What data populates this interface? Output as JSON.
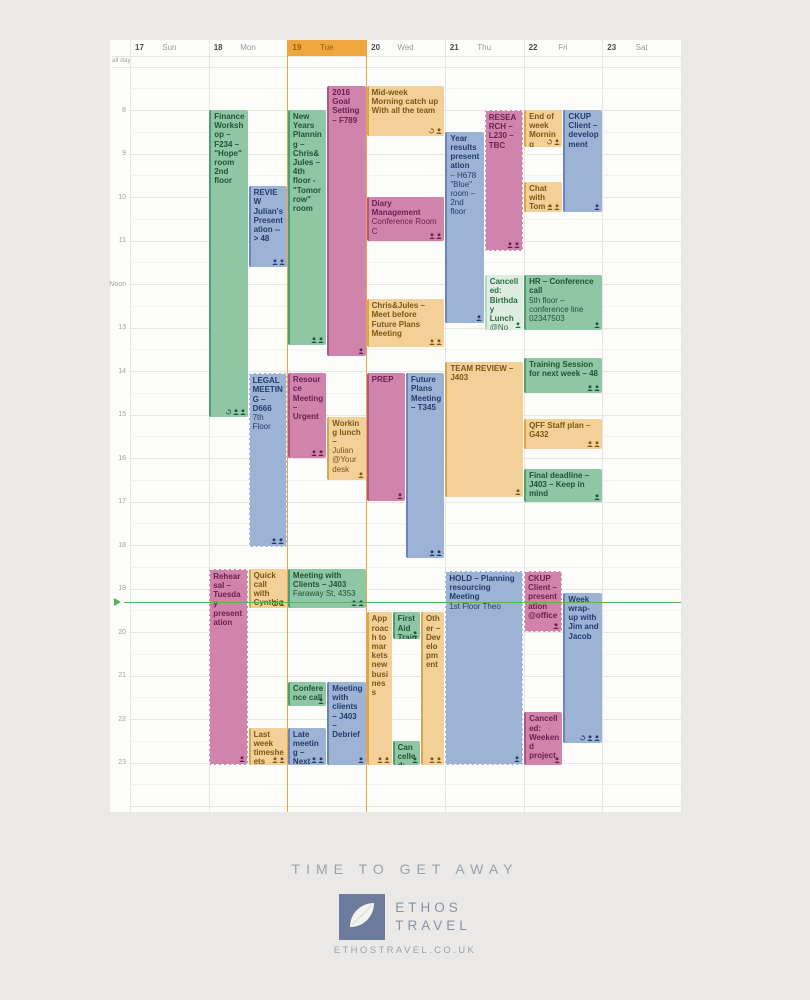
{
  "page": {
    "background": "#eae9e7"
  },
  "calendar": {
    "all_day_label": "all day",
    "days": [
      {
        "num": "17",
        "name": "Sun",
        "today": false
      },
      {
        "num": "18",
        "name": "Mon",
        "today": false
      },
      {
        "num": "19",
        "name": "Tue",
        "today": true
      },
      {
        "num": "20",
        "name": "Wed",
        "today": false
      },
      {
        "num": "21",
        "name": "Thu",
        "today": false
      },
      {
        "num": "22",
        "name": "Fri",
        "today": false
      },
      {
        "num": "23",
        "name": "Sat",
        "today": false
      }
    ],
    "hours": [
      {
        "h": 8,
        "label": "8"
      },
      {
        "h": 9,
        "label": "9"
      },
      {
        "h": 10,
        "label": "10"
      },
      {
        "h": 11,
        "label": "11"
      },
      {
        "h": 12,
        "label": "Noon"
      },
      {
        "h": 13,
        "label": "13"
      },
      {
        "h": 14,
        "label": "14"
      },
      {
        "h": 15,
        "label": "15"
      },
      {
        "h": 16,
        "label": "16"
      },
      {
        "h": 17,
        "label": "17"
      },
      {
        "h": 18,
        "label": "18"
      },
      {
        "h": 19,
        "label": "19"
      },
      {
        "h": 20,
        "label": "20"
      },
      {
        "h": 21,
        "label": "21"
      },
      {
        "h": 22,
        "label": "22"
      },
      {
        "h": 23,
        "label": "23"
      }
    ],
    "now_hour": 19.3,
    "today_color": "#efa63c",
    "now_color": "#57b358"
  },
  "colors": {
    "green": {
      "bg": "#8fc6a4",
      "border": "#4f9e71",
      "text": "#1d5737"
    },
    "greenLight": {
      "bg": "#ddeee0",
      "border": "#b5d8bf",
      "text": "#2e6e45"
    },
    "blue": {
      "bg": "#9db3d6",
      "border": "#6a84b5",
      "text": "#223d6b"
    },
    "pink": {
      "bg": "#d083ab",
      "border": "#b05585",
      "text": "#6b2150"
    },
    "orange": {
      "bg": "#f3d098",
      "border": "#d8a74d",
      "text": "#7b5812"
    }
  },
  "events": [
    {
      "day": 1,
      "lane": [
        0,
        0.5
      ],
      "start": 8.0,
      "end": 15.05,
      "color": "green",
      "dashed": false,
      "title": "Finance Workshop – F234 – \"Hope\" room 2nd floor",
      "detail": "",
      "icons": [
        "repeat",
        "person",
        "person"
      ]
    },
    {
      "day": 1,
      "lane": [
        0.5,
        0.5
      ],
      "start": 9.75,
      "end": 11.6,
      "color": "blue",
      "dashed": false,
      "title": "REVIEW Julian's Presentation --> 48",
      "detail": "",
      "icons": [
        "person",
        "person"
      ]
    },
    {
      "day": 1,
      "lane": [
        0.5,
        0.5
      ],
      "start": 14.05,
      "end": 18.05,
      "color": "blue",
      "dashed": true,
      "title": "LEGAL MEETING – D666",
      "detail": "7th Floor",
      "icons": [
        "person",
        "person"
      ]
    },
    {
      "day": 1,
      "lane": [
        0,
        0.5
      ],
      "start": 18.55,
      "end": 23.05,
      "color": "pink",
      "dashed": true,
      "title": "Rehearsal – Tuesday presentation",
      "detail": "",
      "icons": [
        "person"
      ]
    },
    {
      "day": 1,
      "lane": [
        0.5,
        0.5
      ],
      "start": 18.55,
      "end": 19.45,
      "color": "orange",
      "dashed": false,
      "title": "Quick call with Cynthia – J457",
      "detail": "",
      "icons": [
        "person",
        "person"
      ]
    },
    {
      "day": 1,
      "lane": [
        0.5,
        0.5
      ],
      "start": 22.2,
      "end": 23.05,
      "color": "orange",
      "dashed": false,
      "title": "Last week timesheets supervision – K182",
      "detail": "",
      "icons": [
        "person",
        "person"
      ]
    },
    {
      "day": 2,
      "lane": [
        0,
        0.5
      ],
      "start": 8.0,
      "end": 13.4,
      "color": "green",
      "dashed": false,
      "title": "New Years Planning – Chris&Jules – 4th floor - \"Tomorrow\" room",
      "detail": "",
      "icons": [
        "person",
        "person"
      ]
    },
    {
      "day": 2,
      "lane": [
        0.5,
        0.5
      ],
      "start": 7.45,
      "end": 13.65,
      "color": "pink",
      "dashed": false,
      "title": "2016 Goal Setting – F789",
      "detail": "",
      "icons": [
        "person"
      ]
    },
    {
      "day": 2,
      "lane": [
        0,
        0.5
      ],
      "start": 14.05,
      "end": 16.0,
      "color": "pink",
      "dashed": false,
      "title": "Resource Meeting – Urgent",
      "detail": "",
      "icons": [
        "person",
        "person"
      ]
    },
    {
      "day": 2,
      "lane": [
        0.5,
        0.5
      ],
      "start": 15.05,
      "end": 16.5,
      "color": "orange",
      "dashed": false,
      "title": "Working lunch –",
      "detail": "Julian @Your desk",
      "icons": [
        "person"
      ]
    },
    {
      "day": 2,
      "lane": [
        0,
        1
      ],
      "start": 18.55,
      "end": 19.45,
      "color": "green",
      "dashed": false,
      "title": "Meeting with Clients – J403",
      "detail": "Faraway St, 4353",
      "icons": [
        "person",
        "person"
      ]
    },
    {
      "day": 2,
      "lane": [
        0,
        0.5
      ],
      "start": 21.15,
      "end": 21.7,
      "color": "green",
      "dashed": false,
      "title": "Conference call – contact 02354",
      "detail": "",
      "icons": [
        "person"
      ]
    },
    {
      "day": 2,
      "lane": [
        0.5,
        0.5
      ],
      "start": 21.15,
      "end": 23.05,
      "color": "blue",
      "dashed": false,
      "title": "Meeting with clients – J403 – Debrief",
      "detail": "",
      "icons": [
        "person"
      ]
    },
    {
      "day": 2,
      "lane": [
        0,
        0.5
      ],
      "start": 22.2,
      "end": 23.05,
      "color": "blue",
      "dashed": false,
      "title": "Late meeting – Next steps",
      "detail": "",
      "icons": [
        "person",
        "person"
      ]
    },
    {
      "day": 3,
      "lane": [
        0,
        1
      ],
      "start": 7.45,
      "end": 8.6,
      "color": "orange",
      "dashed": false,
      "title": "Mid-week Morning catch up With all the team",
      "detail": "",
      "icons": [
        "repeat",
        "person"
      ]
    },
    {
      "day": 3,
      "lane": [
        0,
        1
      ],
      "start": 10.0,
      "end": 11.0,
      "color": "pink",
      "dashed": false,
      "title": "Diary Management",
      "detail": "Conference Room C",
      "icons": [
        "person",
        "person"
      ]
    },
    {
      "day": 3,
      "lane": [
        0,
        1
      ],
      "start": 12.35,
      "end": 13.45,
      "color": "orange",
      "dashed": false,
      "title": "Chris&Jules – Meet before Future Plans Meeting",
      "detail": "",
      "icons": [
        "person",
        "person"
      ]
    },
    {
      "day": 3,
      "lane": [
        0,
        0.5
      ],
      "start": 14.05,
      "end": 17.0,
      "color": "pink",
      "dashed": false,
      "title": "PREP",
      "detail": "",
      "icons": [
        "person"
      ]
    },
    {
      "day": 3,
      "lane": [
        0.5,
        0.5
      ],
      "start": 14.05,
      "end": 18.3,
      "color": "blue",
      "dashed": false,
      "title": "Future Plans Meeting – T345",
      "detail": "",
      "icons": [
        "person",
        "person"
      ]
    },
    {
      "day": 3,
      "lane": [
        0,
        0.33
      ],
      "start": 19.55,
      "end": 23.05,
      "color": "orange",
      "dashed": false,
      "title": "Approach to markets new business",
      "detail": "",
      "icons": [
        "person",
        "person"
      ]
    },
    {
      "day": 3,
      "lane": [
        0.33,
        0.36
      ],
      "start": 19.55,
      "end": 20.15,
      "color": "green",
      "dashed": false,
      "title": "First Aid Training",
      "detail": "",
      "icons": [
        "person"
      ]
    },
    {
      "day": 3,
      "lane": [
        0.33,
        0.36
      ],
      "start": 22.5,
      "end": 23.05,
      "color": "green",
      "dashed": false,
      "title": "Cancelled: Drinks",
      "detail": "",
      "icons": [
        "person"
      ]
    },
    {
      "day": 3,
      "lane": [
        0.69,
        0.31
      ],
      "start": 19.55,
      "end": 23.05,
      "color": "orange",
      "dashed": false,
      "title": "Other – Development",
      "detail": "",
      "icons": [
        "person",
        "person"
      ]
    },
    {
      "day": 4,
      "lane": [
        0,
        0.5
      ],
      "start": 8.5,
      "end": 12.9,
      "color": "blue",
      "dashed": false,
      "title": "Year results presentation",
      "detail": "– H678 \"Blue\" room – 2nd floor",
      "icons": [
        "person"
      ]
    },
    {
      "day": 4,
      "lane": [
        0.5,
        0.5
      ],
      "start": 8.0,
      "end": 11.25,
      "color": "pink",
      "dashed": true,
      "title": "RESEARCH – L230 – TBC",
      "detail": "",
      "icons": [
        "person",
        "person"
      ]
    },
    {
      "day": 4,
      "lane": [
        0.5,
        0.5
      ],
      "start": 11.8,
      "end": 13.05,
      "color": "greenLight",
      "dashed": false,
      "title": "Cancelled: Birthday Lunch",
      "detail": "@No Way Restaurant",
      "icons": [
        "person"
      ]
    },
    {
      "day": 4,
      "lane": [
        0,
        1
      ],
      "start": 13.8,
      "end": 16.9,
      "color": "orange",
      "dashed": false,
      "title": "TEAM REVIEW – J403",
      "detail": "",
      "icons": [
        "person"
      ]
    },
    {
      "day": 4,
      "lane": [
        0,
        1
      ],
      "start": 18.6,
      "end": 23.05,
      "color": "blue",
      "dashed": true,
      "title": "HOLD – Planning resourcing Meeting",
      "detail": "1st Floor  Theo",
      "icons": [
        "person"
      ]
    },
    {
      "day": 5,
      "lane": [
        0,
        0.5
      ],
      "start": 8.0,
      "end": 8.85,
      "color": "orange",
      "dashed": false,
      "title": "End of week Morning catch-up",
      "detail": "",
      "icons": [
        "repeat",
        "person"
      ]
    },
    {
      "day": 5,
      "lane": [
        0.5,
        0.5
      ],
      "start": 8.0,
      "end": 10.35,
      "color": "blue",
      "dashed": false,
      "title": "CKUP Client – development",
      "detail": "",
      "icons": [
        "person"
      ]
    },
    {
      "day": 5,
      "lane": [
        0,
        0.5
      ],
      "start": 9.65,
      "end": 10.35,
      "color": "orange",
      "dashed": false,
      "title": "Chat with Tom – Tom's desk",
      "detail": "",
      "icons": [
        "person",
        "person"
      ]
    },
    {
      "day": 5,
      "lane": [
        0,
        1
      ],
      "start": 11.8,
      "end": 13.05,
      "color": "green",
      "dashed": false,
      "title": "HR – Conference call",
      "detail": "5th floor – conference line 02347503",
      "icons": [
        "person"
      ]
    },
    {
      "day": 5,
      "lane": [
        0,
        1
      ],
      "start": 13.7,
      "end": 14.5,
      "color": "green",
      "dashed": false,
      "title": "Training Session for next week – 48",
      "detail": "",
      "icons": [
        "person",
        "person"
      ]
    },
    {
      "day": 5,
      "lane": [
        0,
        1
      ],
      "start": 15.1,
      "end": 15.8,
      "color": "orange",
      "dashed": false,
      "title": "QFF Staff plan – G432",
      "detail": "",
      "icons": [
        "person",
        "person"
      ]
    },
    {
      "day": 5,
      "lane": [
        0,
        1
      ],
      "start": 16.25,
      "end": 17.0,
      "color": "green",
      "dashed": false,
      "title": "Final deadline – J403 – Keep in mind",
      "detail": "",
      "icons": [
        "person"
      ]
    },
    {
      "day": 5,
      "lane": [
        0,
        0.5
      ],
      "start": 18.6,
      "end": 20.0,
      "color": "pink",
      "dashed": true,
      "title": "CKUP Client – presentation @office",
      "detail": "",
      "icons": [
        "person"
      ]
    },
    {
      "day": 5,
      "lane": [
        0.5,
        0.5
      ],
      "start": 19.1,
      "end": 22.55,
      "color": "blue",
      "dashed": false,
      "title": "Week wrap-up with Jim and Jacob",
      "detail": "",
      "icons": [
        "repeat",
        "person",
        "person"
      ]
    },
    {
      "day": 5,
      "lane": [
        0,
        0.5
      ],
      "start": 21.85,
      "end": 23.05,
      "color": "pink",
      "dashed": false,
      "title": "Cancelled: Weekend project",
      "detail": "",
      "icons": [
        "person"
      ]
    }
  ],
  "footer": {
    "tagline": "TIME TO GET AWAY",
    "brand_line1": "ETHOS",
    "brand_line2": "TRAVEL",
    "url": "ETHOSTRAVEL.CO.UK",
    "logo_color": "#6b7c9c"
  }
}
